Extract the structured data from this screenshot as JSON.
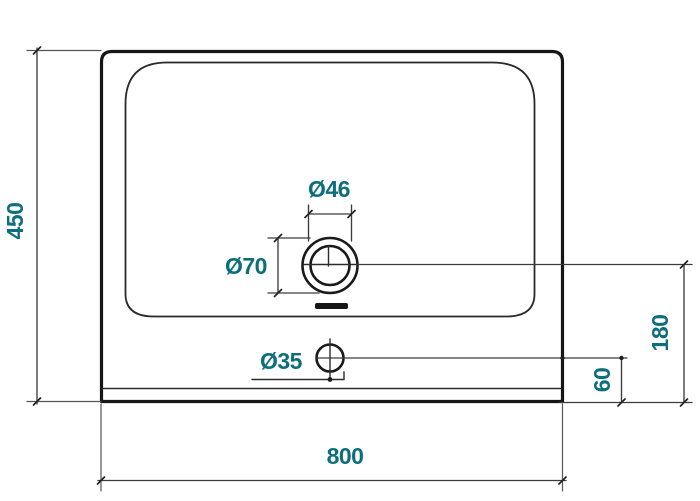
{
  "diagram": {
    "labels": {
      "overall_height": "450",
      "overall_width": "800",
      "tap_hole_inner_diameter": "Ø46",
      "tap_hole_outer_diameter": "Ø70",
      "drain_hole_diameter": "Ø35",
      "tap_center_to_front_edge": "180",
      "drain_center_to_front_edge": "60"
    },
    "colors": {
      "dimension_text": "#0d6f7c",
      "outline": "#161616",
      "background": "#ffffff"
    }
  }
}
